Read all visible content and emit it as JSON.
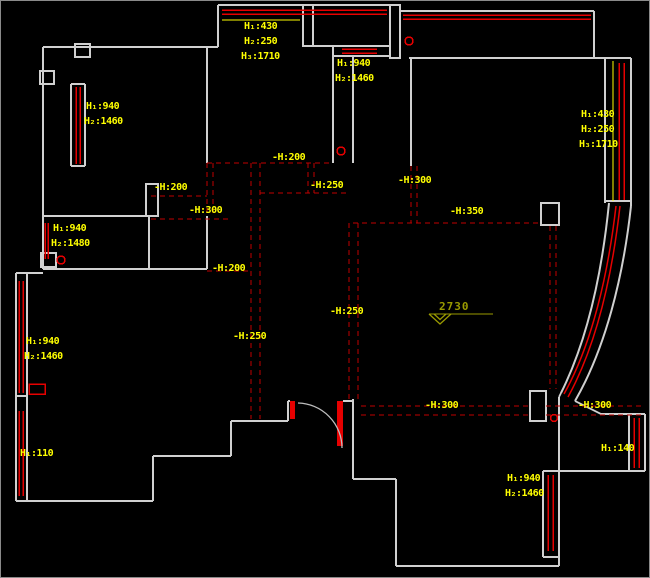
{
  "drawing": {
    "type": "ceiling-plan-cad-floorplan",
    "background": "#000000",
    "colors": {
      "wall": "#d0d0d0",
      "window_line": "#e60000",
      "ceiling_dash": "#c00000",
      "annotation_text": "#ffff00",
      "level_mark": "#9a9a00"
    }
  },
  "window_labels": [
    {
      "id": "top-center-window",
      "lines": [
        "H₁:430",
        "H₂:250",
        "H₃:1710"
      ]
    },
    {
      "id": "kitchen-window",
      "lines": [
        "H₁:940",
        "H₂:1460"
      ]
    },
    {
      "id": "top-left-window",
      "lines": [
        "H₁:940",
        "H₂:1460"
      ]
    },
    {
      "id": "right-window",
      "lines": [
        "H₁:430",
        "H₂:250",
        "H₃:1710"
      ]
    },
    {
      "id": "left-middle-window",
      "lines": [
        "H₁:940",
        "H₂:1480"
      ]
    },
    {
      "id": "left-lower-window",
      "lines": [
        "H₁:940",
        "H₂:1460"
      ]
    },
    {
      "id": "left-bottom-window",
      "lines": [
        "H₁:110"
      ]
    },
    {
      "id": "bay-right-window",
      "lines": [
        "H₁:140"
      ]
    },
    {
      "id": "bottom-right-window",
      "lines": [
        "H₁:940",
        "H₂:1460"
      ]
    }
  ],
  "ceiling_labels": [
    {
      "id": "c1",
      "text": "-H:200"
    },
    {
      "id": "c2",
      "text": "-H:300"
    },
    {
      "id": "c3",
      "text": "-H:200"
    },
    {
      "id": "c4",
      "text": "-H:250"
    },
    {
      "id": "c5",
      "text": "-H:300"
    },
    {
      "id": "c6",
      "text": "-H:350"
    },
    {
      "id": "c7",
      "text": "-H:200"
    },
    {
      "id": "c8",
      "text": "-H:250"
    },
    {
      "id": "c9",
      "text": "-H:250"
    },
    {
      "id": "c10",
      "text": "-H:300"
    },
    {
      "id": "c11",
      "text": "-H:300"
    }
  ],
  "level_mark": {
    "text": "2730"
  }
}
